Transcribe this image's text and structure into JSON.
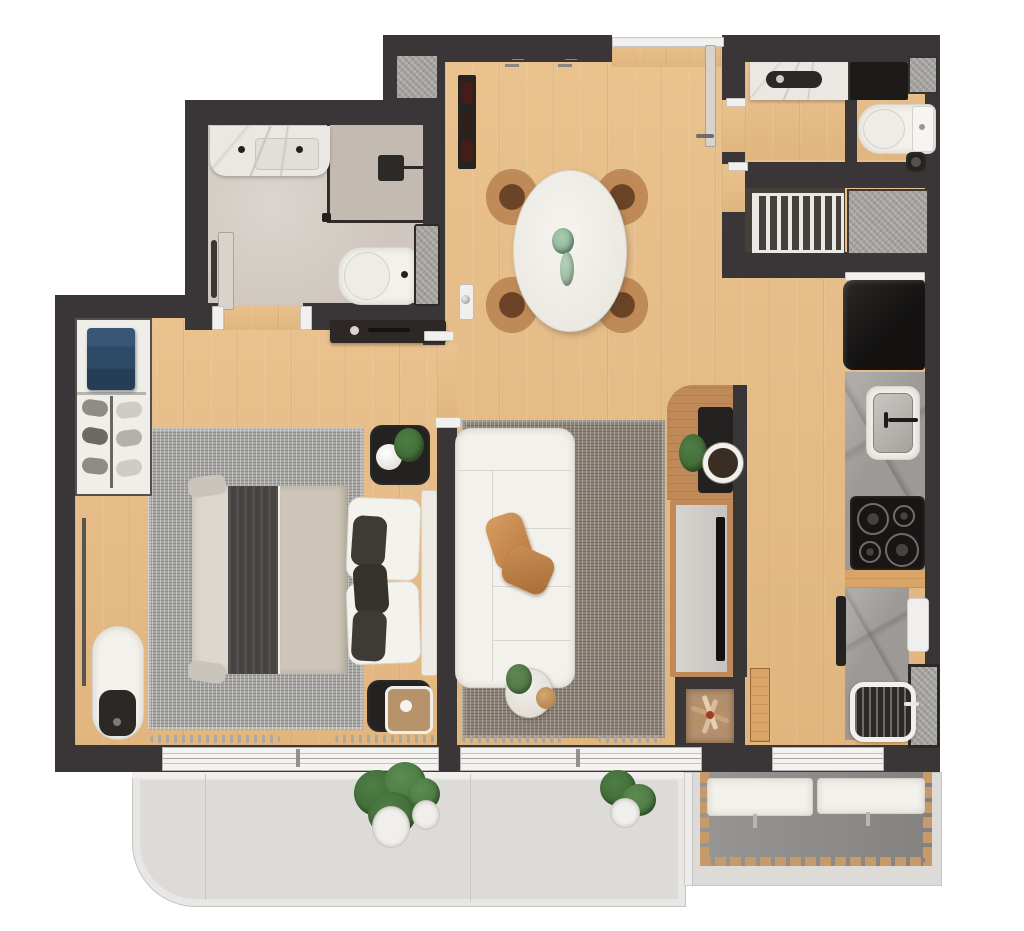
{
  "meta": {
    "kind": "3d-rendered-apartment-floor-plan-top-view",
    "has_text": false
  },
  "colors": {
    "wall": "#3a3637",
    "glass": "#2f2c29",
    "wood": "#e6bb84",
    "wood_deep": "#d9a567",
    "wood_furn": "#c08a58",
    "bath": "#cfc7bf",
    "shower": "#c3bab1",
    "tile": "#a3a19e",
    "dark_floor": "#454039",
    "rug_bed": "#a8a7a3",
    "rug_liv": "#8d8377",
    "white_f": "#f3f1eb",
    "cream": "#dcd8cf",
    "blanket": "#cdc5b8",
    "runner": "#474340",
    "black_f": "#242220",
    "charcoal": "#171614",
    "tan": "#c68d55",
    "green": "#4f7d46",
    "green2": "#3a652f",
    "green_pale": "#a9cbb0",
    "blue": "#2f4a67",
    "marble": "#ebe8e4",
    "stone": "#9c9996",
    "balcony": "#dcdbd7",
    "curb": "#f0efed",
    "deck": "#8f8d8a",
    "deck_wood": "#c79a6b",
    "window": "#f4f3f1",
    "win_line": "#b7b4b0",
    "niche_floor": "#b3906e",
    "door_leaf": "#d8d3cb"
  },
  "rooms": [
    {
      "id": "bathroom",
      "furniture": [
        "vanity-counter",
        "shower",
        "toilet",
        "wall-niche",
        "door"
      ]
    },
    {
      "id": "hallway",
      "furniture": [
        "sideboard",
        "wall-switch"
      ]
    },
    {
      "id": "dining-area",
      "furniture": [
        "oval-table",
        "four-chairs",
        "centerpiece-plant",
        "wine-rack",
        "pendant-lights",
        "entry-door"
      ]
    },
    {
      "id": "bedroom",
      "furniture": [
        "double-bed",
        "headboard-cushions",
        "area-rug",
        "nightstand-with-plant-and-lamp",
        "nightstand-with-tray",
        "wardrobe-shelves",
        "folded-blue-clothes",
        "shoe-shelves",
        "mirror-rail",
        "bench-with-cushion",
        "curtains",
        "sliding-window"
      ]
    },
    {
      "id": "living-room",
      "furniture": [
        "white-sofa",
        "tan-pillows",
        "area-rug",
        "side-table-with-plant",
        "tv-console",
        "tv",
        "corner-desk-with-plant-and-bowl",
        "curtains",
        "sliding-window"
      ]
    },
    {
      "id": "kitchen",
      "furniture": [
        "refrigerator",
        "sink-counter",
        "faucet",
        "cooktop-4-burners",
        "lower-counter",
        "cutting-board",
        "towel",
        "grill",
        "side-niche",
        "wood-panel",
        "window"
      ]
    },
    {
      "id": "laundry",
      "furniture": [
        "washer-under-marble-counter",
        "black-cabinet",
        "floor-mat",
        "toilet",
        "waste-bin"
      ]
    },
    {
      "id": "technical-area",
      "furniture": [
        "drying-rack",
        "tile-platform"
      ]
    },
    {
      "id": "balcony",
      "furniture": [
        "potted-plants",
        "curved-slab"
      ]
    },
    {
      "id": "gourmet-balcony",
      "furniture": [
        "wood-deck-border",
        "two-white-benches"
      ]
    },
    {
      "id": "decor-niche",
      "furniture": [
        "dried-plant-arrangement"
      ]
    }
  ]
}
